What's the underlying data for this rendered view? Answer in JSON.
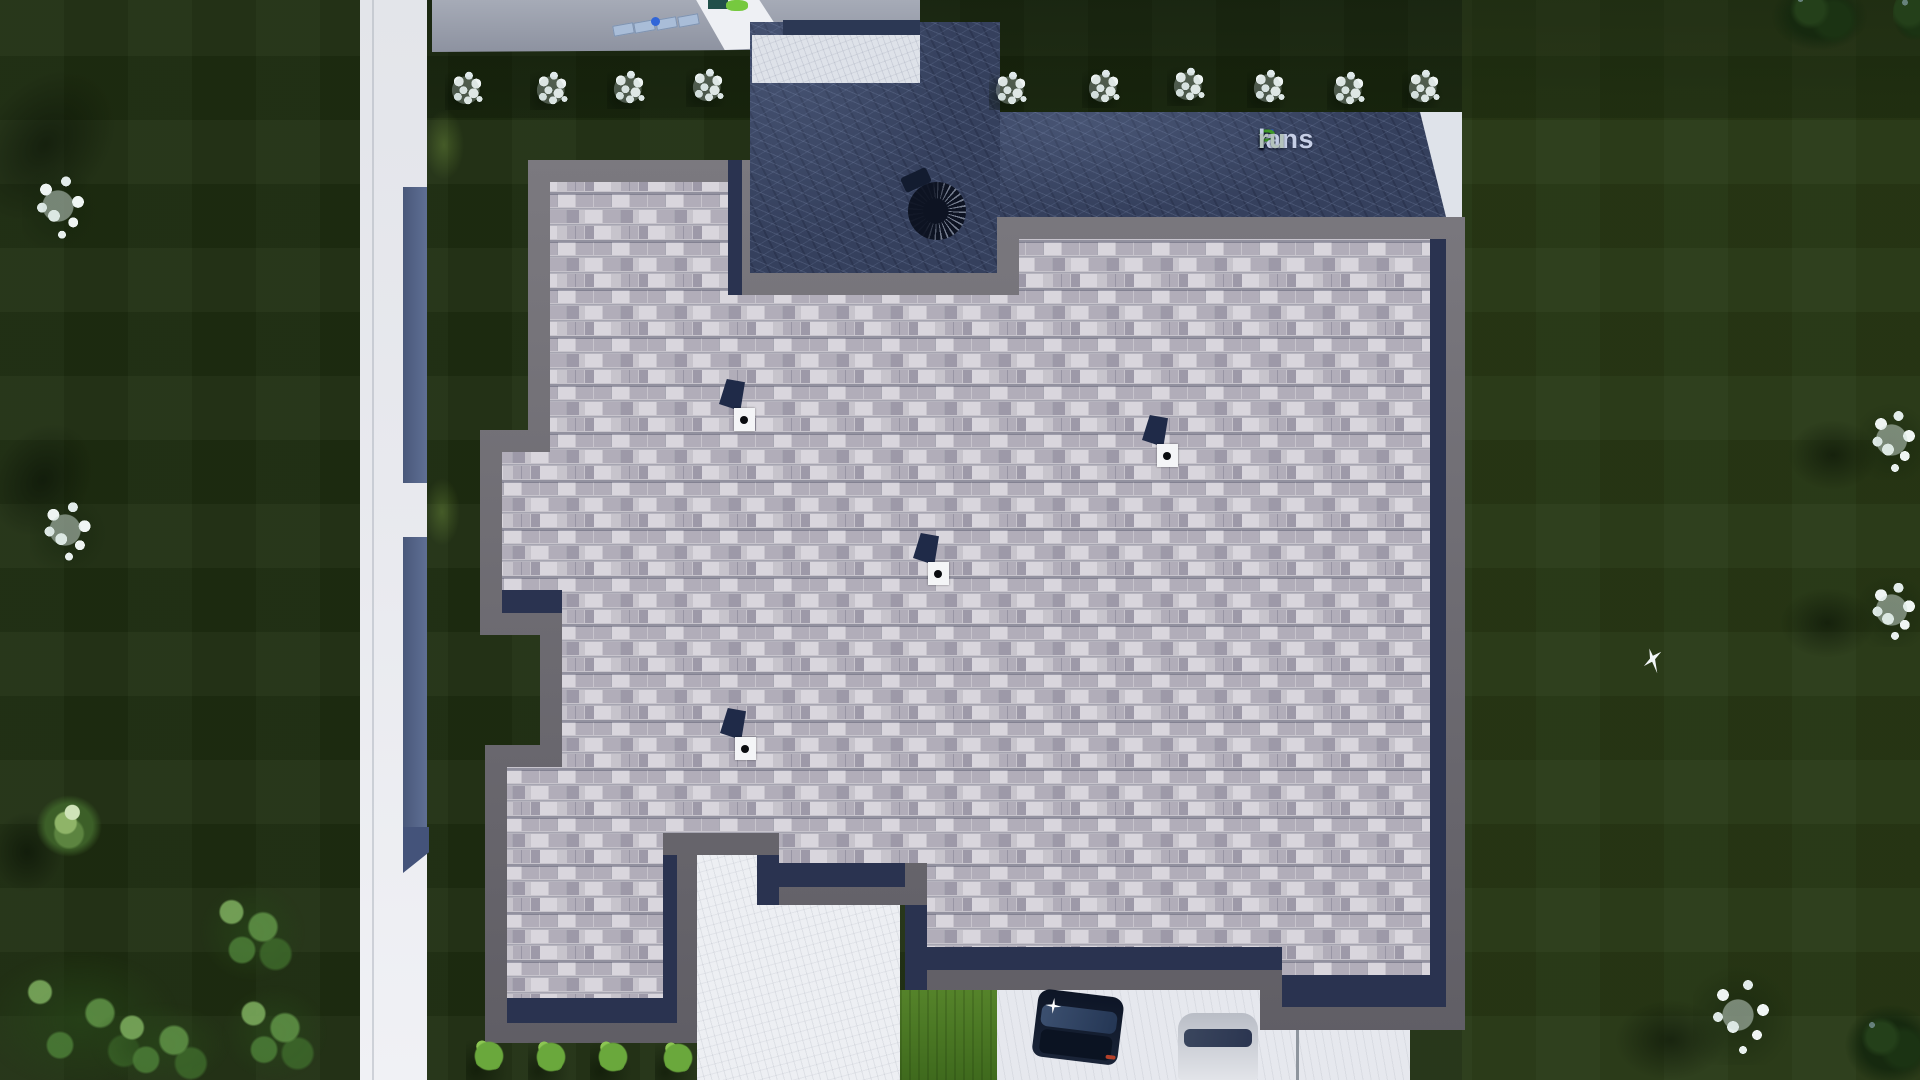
{
  "meta": {
    "scene_type": "aerial top-down 3D render of a house roof plan with landscaped plot",
    "source_watermark": "FixPlans.ru"
  },
  "watermark": {
    "full_text": "FixPlans.ru",
    "parts": [
      {
        "text": "F",
        "css": "color:#2c62c9"
      },
      {
        "text": "i",
        "css": "color:#2c62c9"
      },
      {
        "text": "x",
        "css": "color:#c6cfe6"
      },
      {
        "text": "P",
        "css": "color:#3e9a27"
      },
      {
        "text": "lans",
        "css": "color:#c6cfe6"
      },
      {
        "text": ".",
        "css": "color:#2c62c9"
      },
      {
        "text": "ru",
        "css": "color:#b4c3bb"
      }
    ]
  },
  "palette": {
    "lawn_dark": "#1f2e11",
    "roof_shingle": "#c7c4cc",
    "roof_border_gray": "#6e6c72",
    "roof_fascia_navy": "#2a3350",
    "terrace_stone": "#35405d",
    "patio_light": "#dee2e9",
    "road_white": "#e8e9ee",
    "boundary_wall": "#57678a",
    "street_gray": "#9aa0ac",
    "shrub_white": "#ecf2f1",
    "shrub_bright_green": "#6aa83c",
    "car_dark": "#141c2e",
    "car_light": "#d4d7dc",
    "logo_blue": "#2c62c9",
    "logo_green": "#3e9a27"
  },
  "scene": {
    "building": {
      "roof_vents": 4,
      "terrace": 1,
      "patio_pad": 1,
      "grill_object": 1
    },
    "vehicles": {
      "dark_car": 1,
      "light_car": 1
    },
    "landscape": {
      "white_shrubs_top_row": 10,
      "bright_shrubs_bottom_row": 4,
      "white_trees": 5,
      "green_tree_clusters": 5,
      "flying_bird": 1
    },
    "paths": {
      "left_road": 1,
      "top_street": 1,
      "driveway": 1,
      "parking_pad": 1
    }
  }
}
